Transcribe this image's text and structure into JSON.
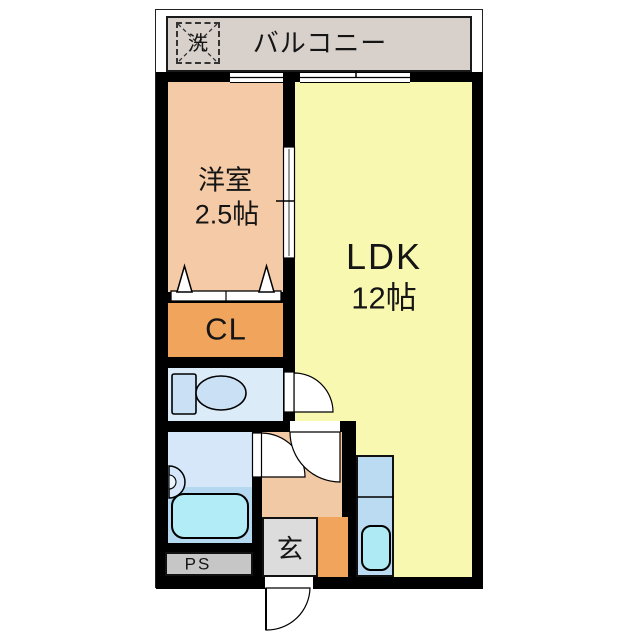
{
  "plan": {
    "title": "1LDK apartment floor plan",
    "balcony": {
      "label": "バルコニー",
      "washer_label": "洗"
    },
    "rooms": {
      "western_room": {
        "name": "洋室",
        "size": "2.5帖"
      },
      "ldk": {
        "name": "LDK",
        "size": "12帖"
      },
      "closet": {
        "label": "CL"
      },
      "entrance": {
        "label": "玄"
      },
      "pipe_space": {
        "label": "PS"
      }
    },
    "fixtures": [
      "washing-machine-space",
      "toilet",
      "washbasin",
      "bathtub",
      "kitchen-sink",
      "entrance-door",
      "sliding-door",
      "closet-folding-door",
      "windows"
    ],
    "colors": {
      "wall": "#000000",
      "balcony_floor": "#d8d0cb",
      "western_room": "#f5cba7",
      "ldk": "#f9f8b0",
      "closet": "#f0a45c",
      "toilet_room": "#dcebf8",
      "bathroom_upper": "#d5e7f8",
      "bathroom_lower": "#b4d8ef",
      "bathtub": "#b2ecf6",
      "kitchen_counter": "#badbf2",
      "kitchen_sink": "#aeeaf4",
      "hallway": "#f2c9a5",
      "entrance_floor": "#dcdcdc",
      "pipe_space": "#c6c6c6"
    }
  }
}
